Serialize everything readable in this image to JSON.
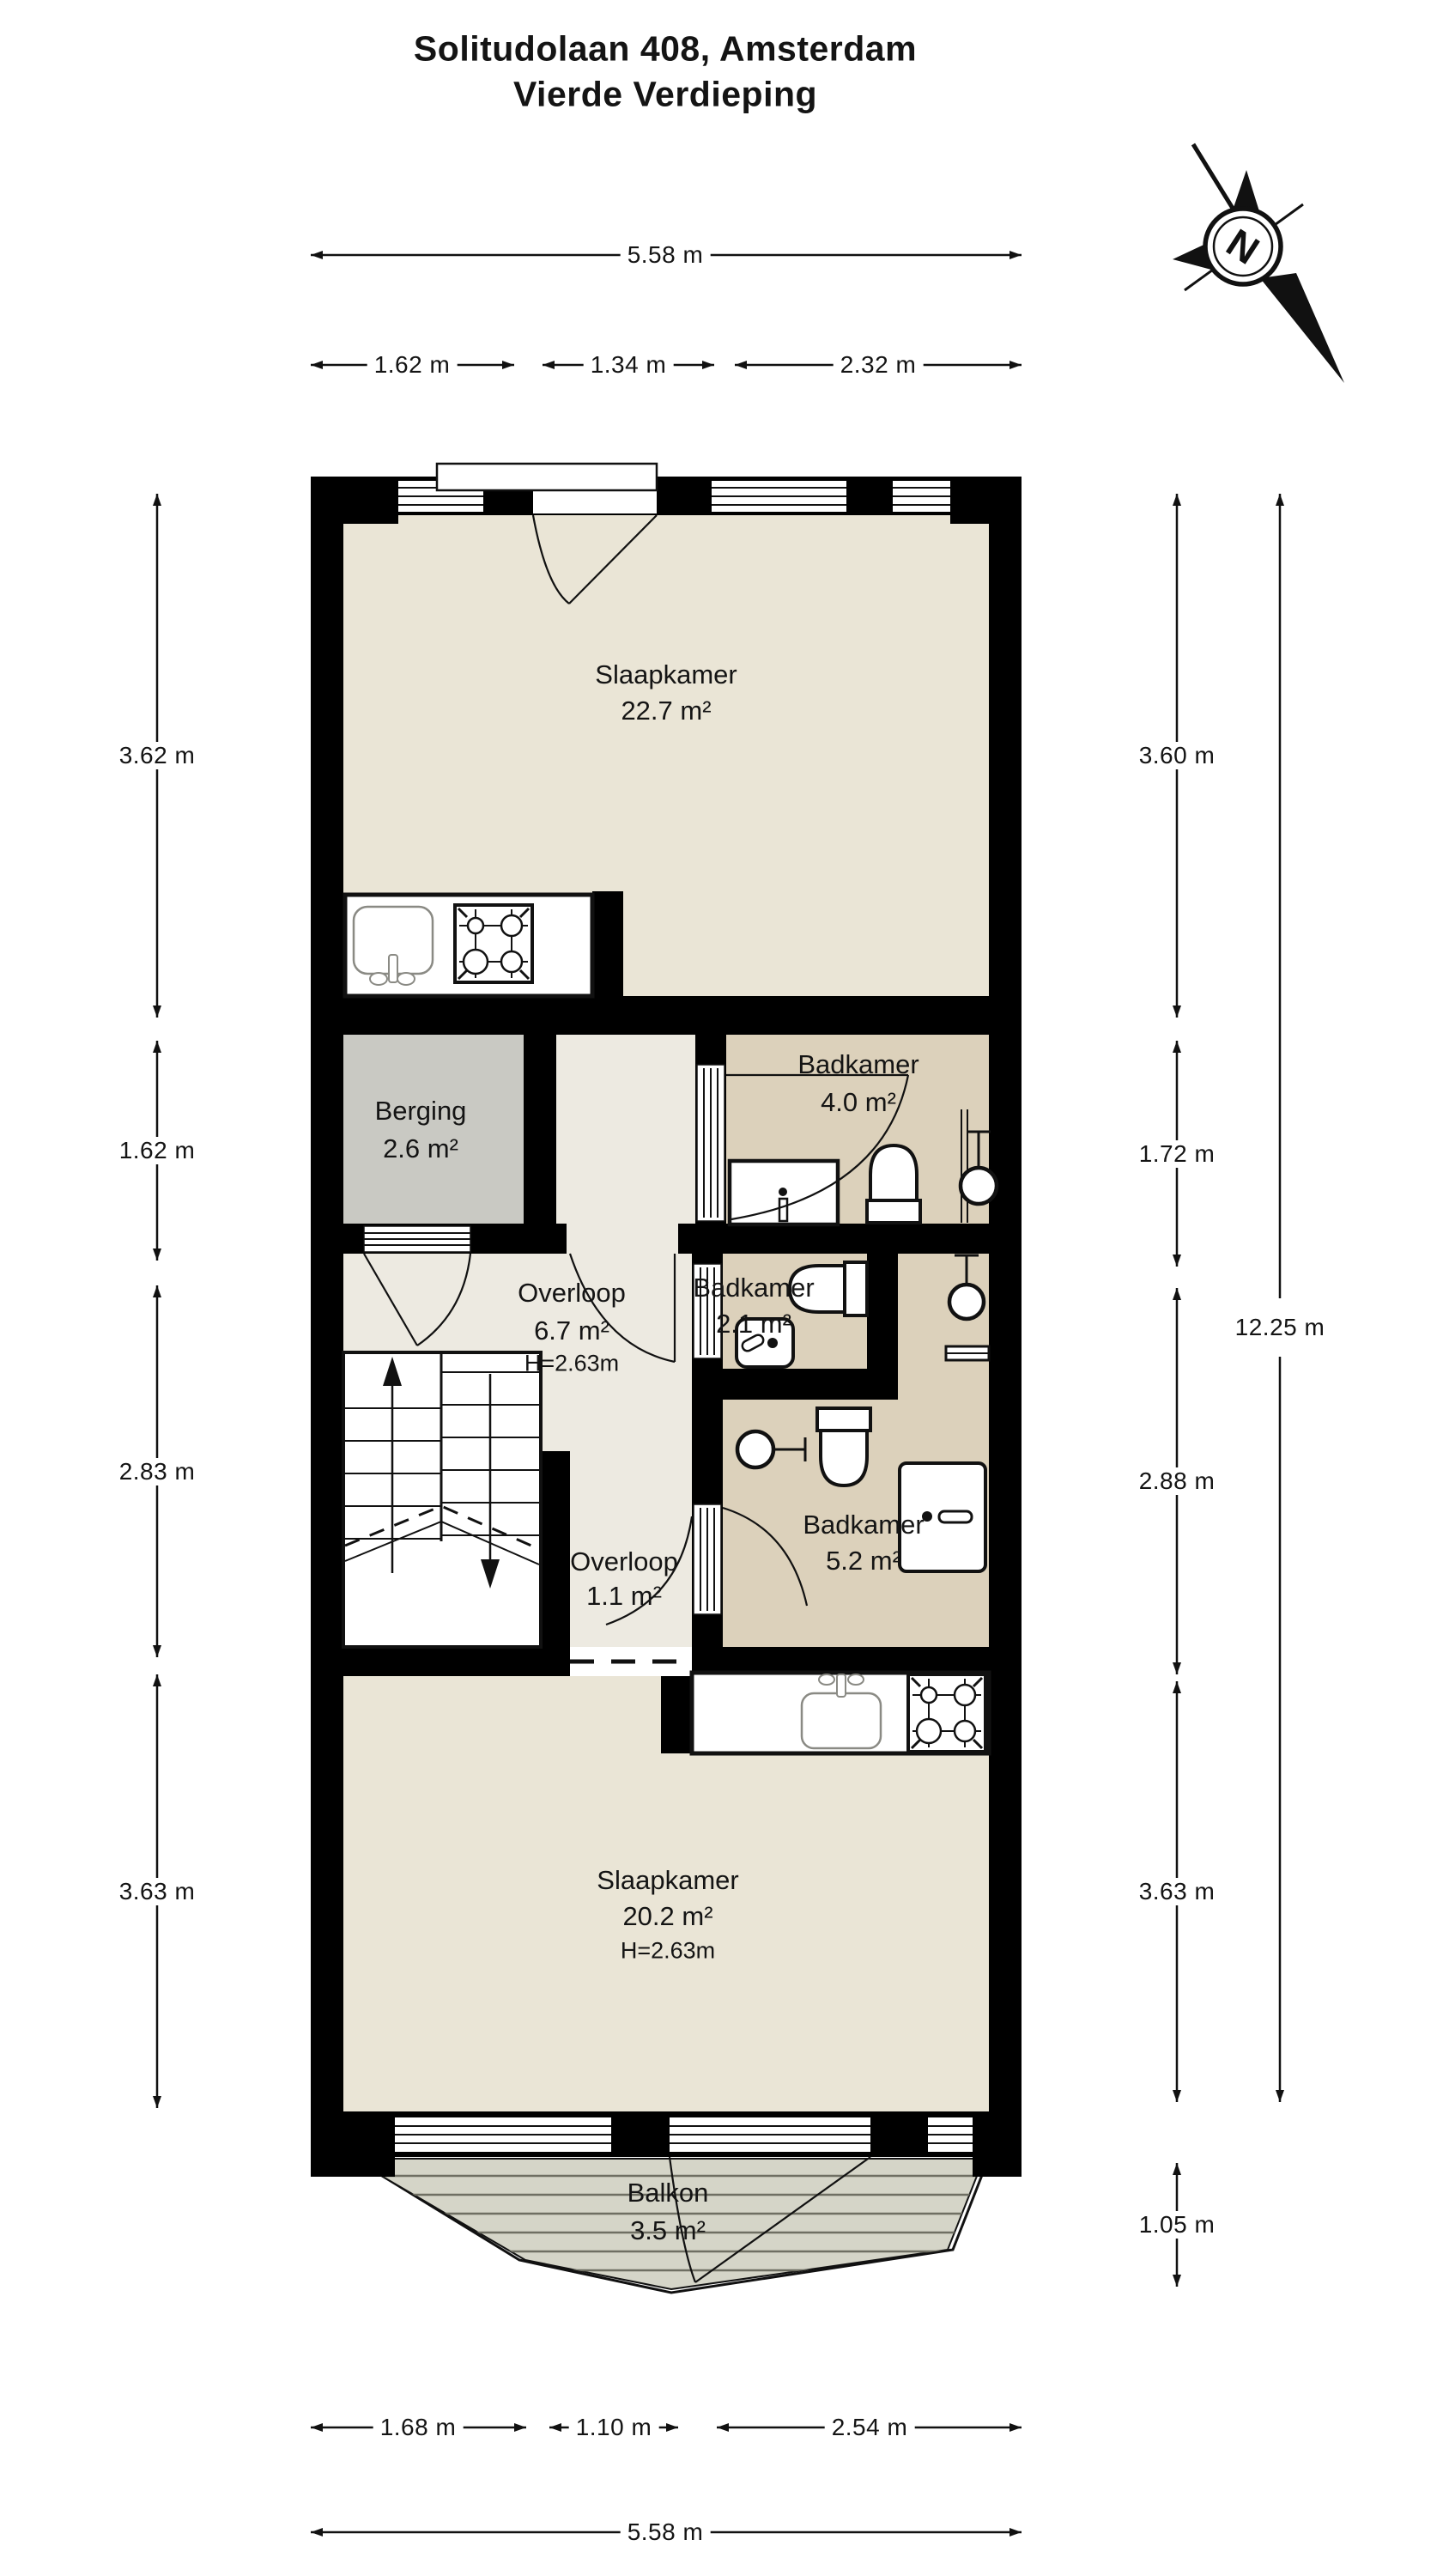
{
  "title": {
    "line1": "Solitudolaan 408, Amsterdam",
    "line2": "Vierde Verdieping"
  },
  "compass": {
    "label": "N"
  },
  "rooms": [
    {
      "name": "Slaapkamer",
      "area": "22.7 m²"
    },
    {
      "name": "Berging",
      "area": "2.6 m²"
    },
    {
      "name": "Badkamer",
      "area": "4.0 m²"
    },
    {
      "name": "Overloop",
      "area": "6.7 m²",
      "height": "H=2.63m"
    },
    {
      "name": "Badkamer",
      "area": "2.1 m²"
    },
    {
      "name": "Badkamer",
      "area": "5.2 m²"
    },
    {
      "name": "Overloop",
      "area": "1.1 m²"
    },
    {
      "name": "Slaapkamer",
      "area": "20.2 m²",
      "height": "H=2.63m"
    },
    {
      "name": "Balkon",
      "area": "3.5 m²"
    }
  ],
  "dims": {
    "top_total": {
      "label": "5.58 m"
    },
    "top_segments": [
      {
        "label": "1.62 m"
      },
      {
        "label": "1.34 m"
      },
      {
        "label": "2.32 m"
      }
    ],
    "left": [
      {
        "label": "3.62 m"
      },
      {
        "label": "1.62 m"
      },
      {
        "label": "2.83 m"
      },
      {
        "label": "3.63 m"
      }
    ],
    "right": [
      {
        "label": "3.60 m"
      },
      {
        "label": "1.72 m"
      },
      {
        "label": "2.88 m"
      },
      {
        "label": "3.63 m"
      },
      {
        "label": "1.05 m"
      }
    ],
    "right_total": {
      "label": "12.25 m"
    },
    "bottom_segments": [
      {
        "label": "1.68 m"
      },
      {
        "label": "1.10 m"
      },
      {
        "label": "2.54 m"
      }
    ],
    "bottom_total": {
      "label": "5.58 m"
    }
  },
  "colors": {
    "wall": "#000000",
    "bedroom_fill": "#eae5d6",
    "hall_fill": "#edeae1",
    "bathroom_fill": "#dcd1bb",
    "storage_fill": "#c9c9c3",
    "balcony_fill": "#d5d5c8",
    "text": "#141414"
  }
}
